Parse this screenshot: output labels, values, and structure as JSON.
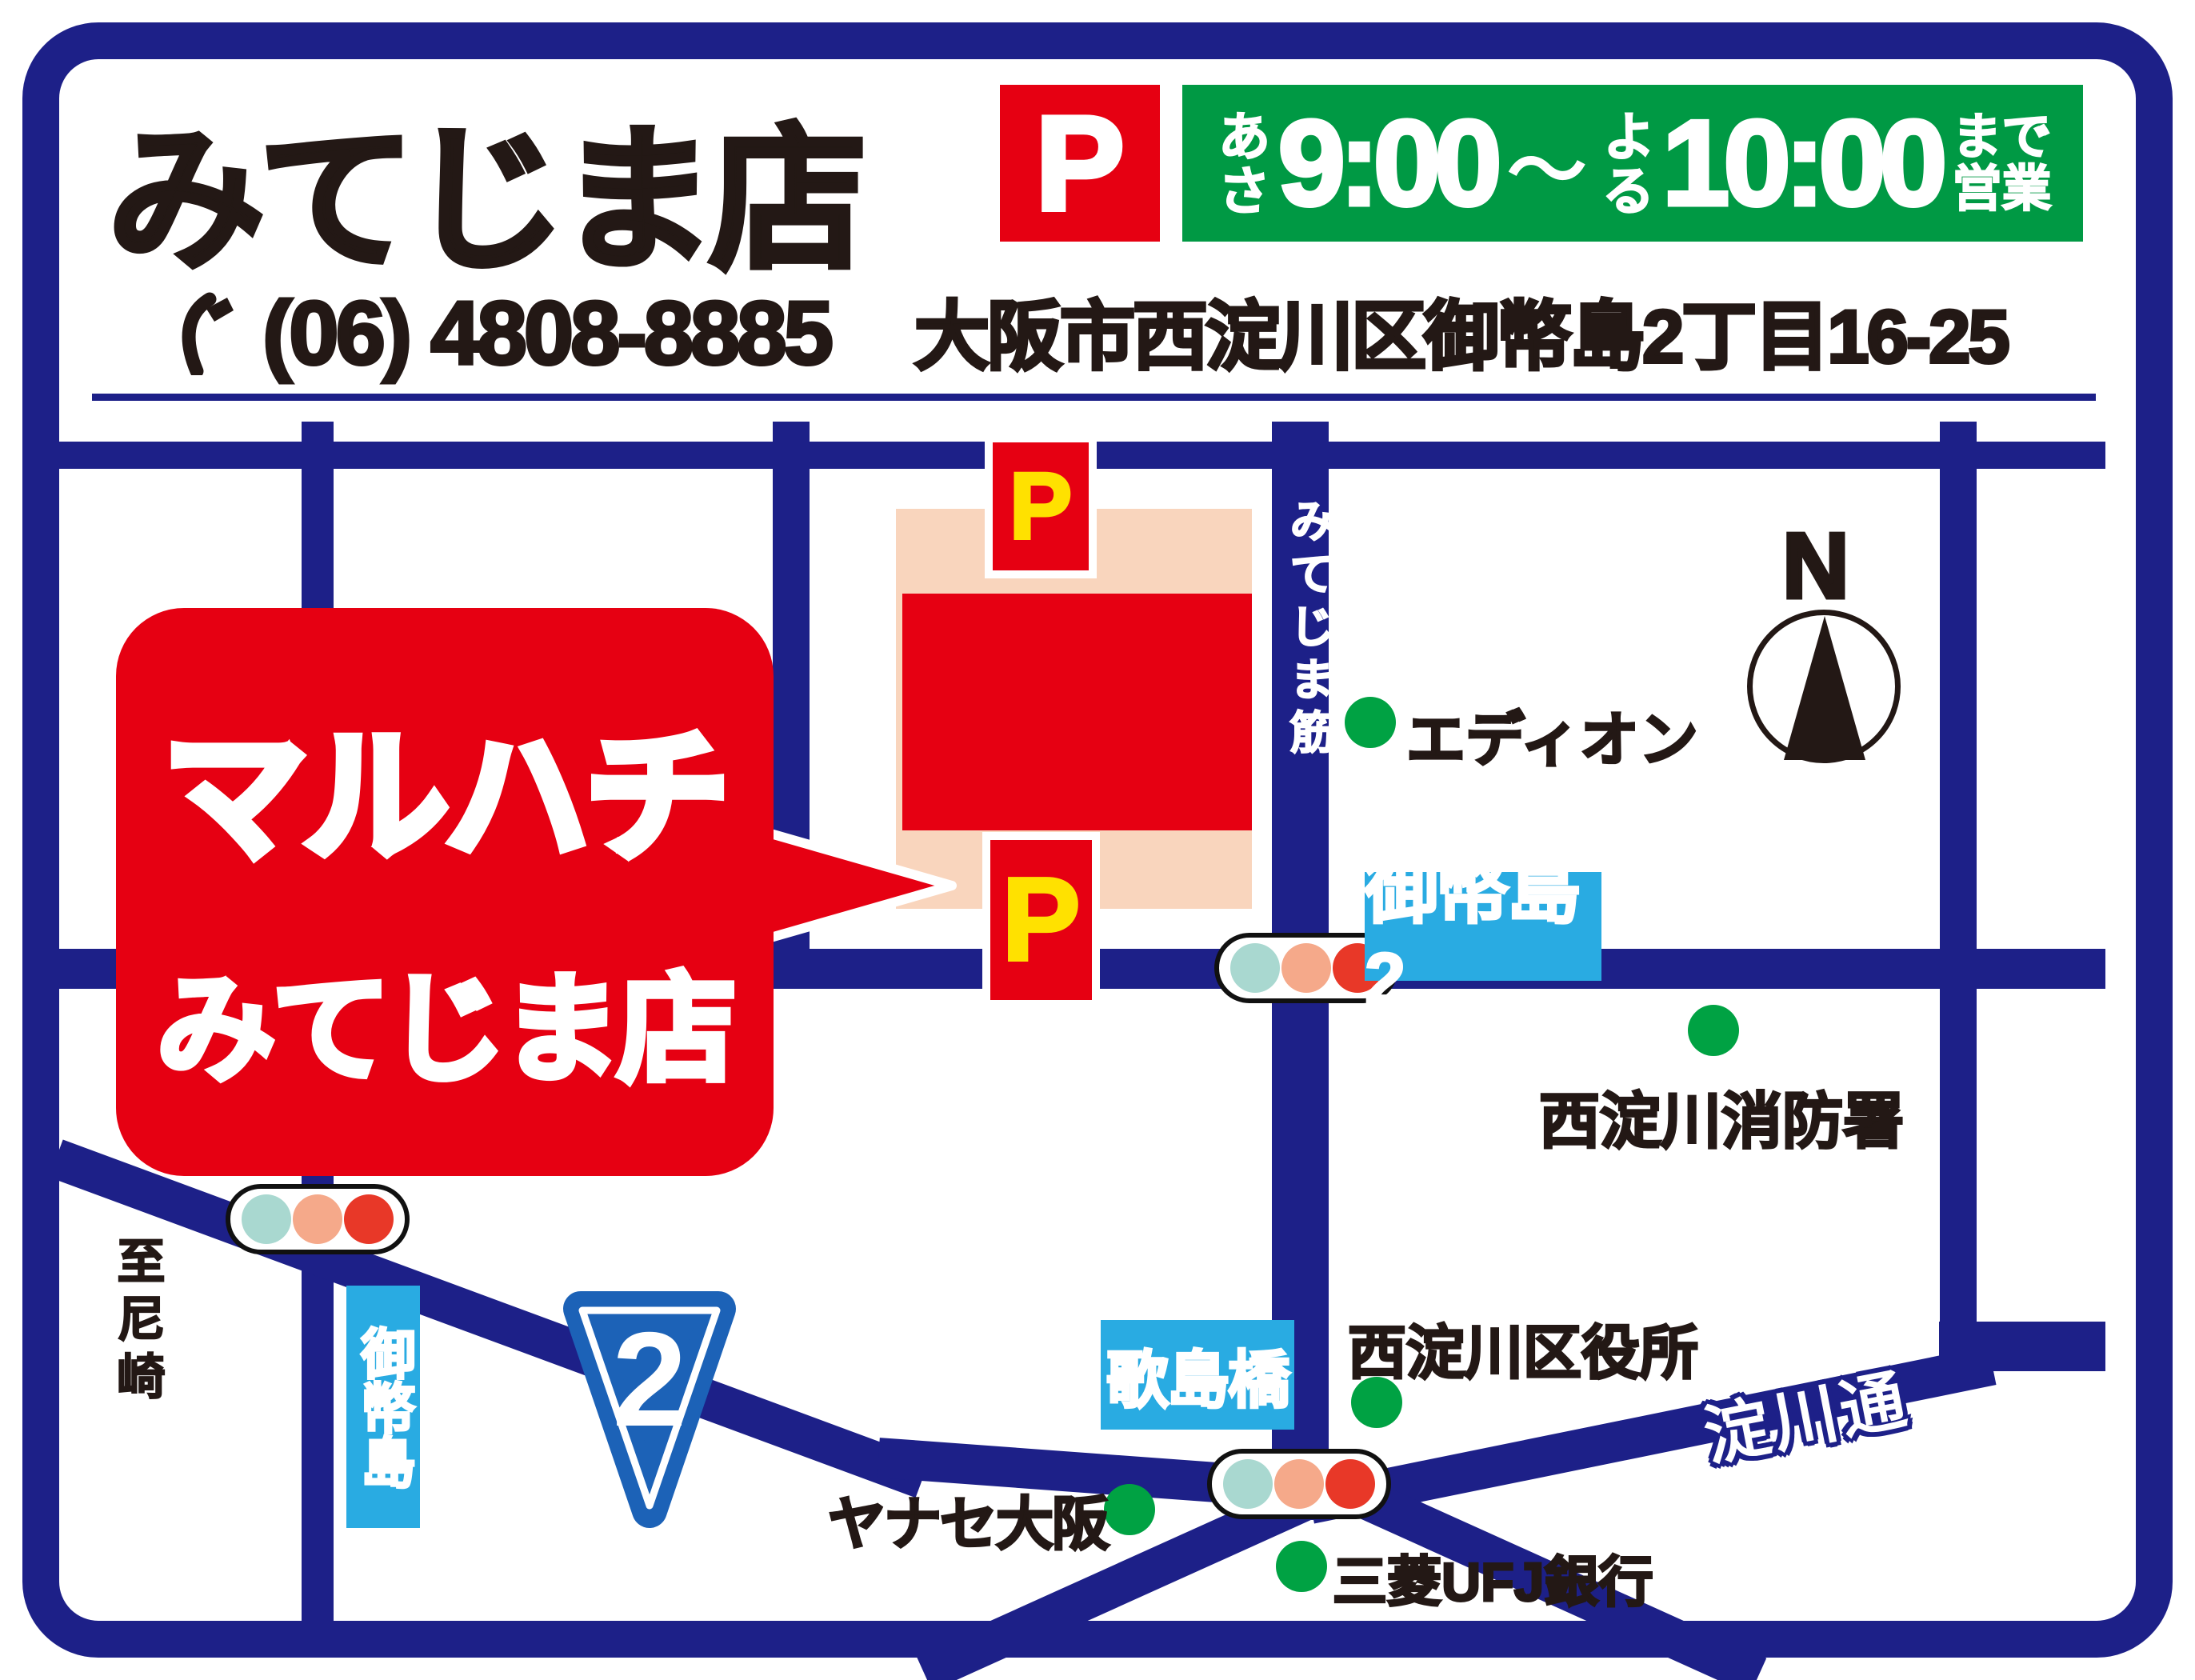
{
  "colors": {
    "navy": "#1d2088",
    "red": "#e60012",
    "yellow": "#ffe100",
    "banner-green": "#009944",
    "dot-green": "#00a243",
    "sign-blue": "#29abe2",
    "parking-pink": "#f9d5bd",
    "tl-teal": "#a9d8d0",
    "tl-salmon": "#f5a98a",
    "tl-red": "#e83828",
    "ink": "#231815",
    "shield-blue": "#1c62b7"
  },
  "header": {
    "store_name": "みてじま店",
    "phone_number": "(06) 4808-8885",
    "parking_badge": "P",
    "hours": {
      "morning_label": "あさ",
      "open_time": "9:00",
      "tilde": "～",
      "evening_label": "よる",
      "close_time": "10:00",
      "suffix": "まで営業"
    },
    "address": "大阪市西淀川区御幣島2丁目16-25"
  },
  "callout": {
    "brand": "マルハチ",
    "branch": "みてじま店"
  },
  "map": {
    "parking_mark": "P",
    "roads": {
      "mitejima_suji": "みてじま筋",
      "yodogawa_dori": "淀川通"
    },
    "signs": {
      "mitejima2": "御幣島2",
      "utajima_bashi": "歌島橋",
      "mitejima": "御幣島",
      "route_number": "2"
    },
    "landmarks": {
      "edion": "エディオン",
      "fire_station": "西淀川消防署",
      "ward_office": "西淀川区役所",
      "yanase_osaka": "ヤナセ大阪",
      "mufg_bank": "三菱UFJ銀行"
    },
    "directions": {
      "to_amagasaki": "至尼崎",
      "north": "N"
    }
  }
}
